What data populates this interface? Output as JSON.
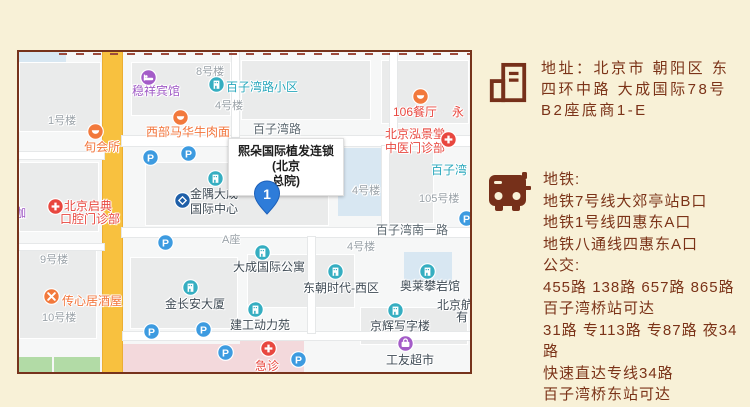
{
  "colors": {
    "bg": "#F8F1D7",
    "panel_text": "#7B3318",
    "panel_icon": "#76301A",
    "map_border": "#76331C",
    "map_bg": "#F6F7F7",
    "road_yellow": "#F8C13F",
    "pin_blue": "#2E7CD9",
    "poi_teal": "#35AEC1",
    "parking_blue": "#3D9BE0",
    "poi_orange": "#F2793C",
    "poi_red": "#E8473F",
    "poi_purple": "#A45CC8",
    "bank_blue": "#1F5FA8"
  },
  "map": {
    "info_box": {
      "lines": [
        "熙朵国际植发连锁(北京",
        "总院)"
      ]
    },
    "pin": {
      "label": "1"
    },
    "labels": [
      {
        "x": 29,
        "y": 63,
        "t": "1号楼",
        "c": "gray"
      },
      {
        "x": 177,
        "y": 14,
        "t": "8号楼",
        "c": "gray"
      },
      {
        "x": 196,
        "y": 48,
        "t": "4号楼",
        "c": "gray"
      },
      {
        "x": 333,
        "y": 133,
        "t": "4号楼",
        "c": "gray"
      },
      {
        "x": 400,
        "y": 141,
        "t": "105号楼",
        "c": "gray"
      },
      {
        "x": 328,
        "y": 189,
        "t": "4号楼",
        "c": "gray"
      },
      {
        "x": 21,
        "y": 202,
        "t": "9号楼",
        "c": "gray"
      },
      {
        "x": 23,
        "y": 260,
        "t": "10号楼",
        "c": "gray"
      },
      {
        "x": 203,
        "y": 182,
        "t": "A座",
        "c": "gray"
      },
      {
        "x": 234,
        "y": 71,
        "t": "百子湾路",
        "c": "road"
      },
      {
        "x": 357,
        "y": 172,
        "t": "百子湾南一路",
        "c": "road"
      },
      {
        "x": 207,
        "y": 29,
        "t": "百子湾路小区",
        "c": "teal"
      },
      {
        "x": 412,
        "y": 112,
        "t": "百子湾",
        "c": "teal"
      },
      {
        "x": 113,
        "y": 33,
        "t": "稳祥宾馆",
        "c": "purple"
      },
      {
        "x": -5,
        "y": 155,
        "t": "咖",
        "c": "purple"
      },
      {
        "x": 65,
        "y": 89,
        "t": "旬会所",
        "c": "orange"
      },
      {
        "x": 127,
        "y": 74,
        "t": "西部马华牛肉面",
        "c": "orange"
      },
      {
        "x": 43,
        "y": 243,
        "t": "传心居酒屋",
        "c": "orange"
      },
      {
        "x": 374,
        "y": 54,
        "t": "106餐厅",
        "c": "red"
      },
      {
        "x": 433,
        "y": 54,
        "t": "永",
        "c": "red"
      },
      {
        "x": 366,
        "y": 76,
        "t": "北京泓景堂",
        "c": "red"
      },
      {
        "x": 366,
        "y": 90,
        "t": "中医门诊部",
        "c": "red"
      },
      {
        "x": 45,
        "y": 148,
        "t": "北京启典",
        "c": "red"
      },
      {
        "x": 41,
        "y": 161,
        "t": "口腔门诊部",
        "c": "red"
      },
      {
        "x": 236,
        "y": 308,
        "t": "急诊",
        "c": "red"
      },
      {
        "x": 171,
        "y": 136,
        "t": "金隅大成",
        "c": "dark"
      },
      {
        "x": 171,
        "y": 151,
        "t": "国际中心",
        "c": "dark"
      },
      {
        "x": 146,
        "y": 246,
        "t": "金长安大厦",
        "c": "dark"
      },
      {
        "x": 211,
        "y": 267,
        "t": "建工动力苑",
        "c": "dark"
      },
      {
        "x": 214,
        "y": 209,
        "t": "大成国际公寓",
        "c": "dark"
      },
      {
        "x": 284,
        "y": 230,
        "t": "东朝时代-西区",
        "c": "dark"
      },
      {
        "x": 381,
        "y": 228,
        "t": "奥莱攀岩馆",
        "c": "dark"
      },
      {
        "x": 351,
        "y": 268,
        "t": "京辉写字楼",
        "c": "dark"
      },
      {
        "x": 367,
        "y": 302,
        "t": "工友超市",
        "c": "dark"
      },
      {
        "x": 418,
        "y": 247,
        "t": "北京航",
        "c": "dark"
      },
      {
        "x": 437,
        "y": 259,
        "t": "有",
        "c": "dark"
      }
    ],
    "markers": [
      {
        "x": 197,
        "y": 32,
        "k": "teal"
      },
      {
        "x": 196,
        "y": 126,
        "k": "teal"
      },
      {
        "x": 171,
        "y": 235,
        "k": "teal"
      },
      {
        "x": 236,
        "y": 257,
        "k": "teal"
      },
      {
        "x": 243,
        "y": 200,
        "k": "teal"
      },
      {
        "x": 316,
        "y": 219,
        "k": "teal"
      },
      {
        "x": 408,
        "y": 219,
        "k": "teal"
      },
      {
        "x": 376,
        "y": 258,
        "k": "teal"
      },
      {
        "x": 129,
        "y": 25,
        "k": "purple-hotel"
      },
      {
        "x": 386,
        "y": 291,
        "k": "purple-shop"
      },
      {
        "x": 76,
        "y": 79,
        "k": "orange"
      },
      {
        "x": 161,
        "y": 65,
        "k": "orange"
      },
      {
        "x": 401,
        "y": 44,
        "k": "orange"
      },
      {
        "x": 32,
        "y": 244,
        "k": "orange-x"
      },
      {
        "x": 429,
        "y": 87,
        "k": "red"
      },
      {
        "x": 36,
        "y": 154,
        "k": "red"
      },
      {
        "x": 249,
        "y": 296,
        "k": "red"
      },
      {
        "x": 163,
        "y": 148,
        "k": "bank"
      },
      {
        "x": 131,
        "y": 105,
        "k": "p"
      },
      {
        "x": 169,
        "y": 101,
        "k": "p"
      },
      {
        "x": 146,
        "y": 190,
        "k": "p"
      },
      {
        "x": 132,
        "y": 279,
        "k": "p"
      },
      {
        "x": 184,
        "y": 277,
        "k": "p"
      },
      {
        "x": 206,
        "y": 300,
        "k": "p"
      },
      {
        "x": 279,
        "y": 307,
        "k": "p"
      },
      {
        "x": 447,
        "y": 166,
        "k": "p"
      }
    ]
  },
  "panel": {
    "address": {
      "lines": [
        "地址：北京市 朝阳区 东",
        "四环中路 大成国际78号",
        "B2座底商1-E"
      ]
    },
    "transit": {
      "lines": [
        "地铁:",
        "地铁7号线大郊亭站B口",
        "地铁1号线四惠东A口",
        "地铁八通线四惠东A口",
        "公交:",
        "455路 138路  657路  865路",
        "百子湾桥站可达",
        "31路 专113路 专87路  夜34路",
        "快速直达专线34路",
        "百子湾桥东站可达"
      ]
    }
  }
}
